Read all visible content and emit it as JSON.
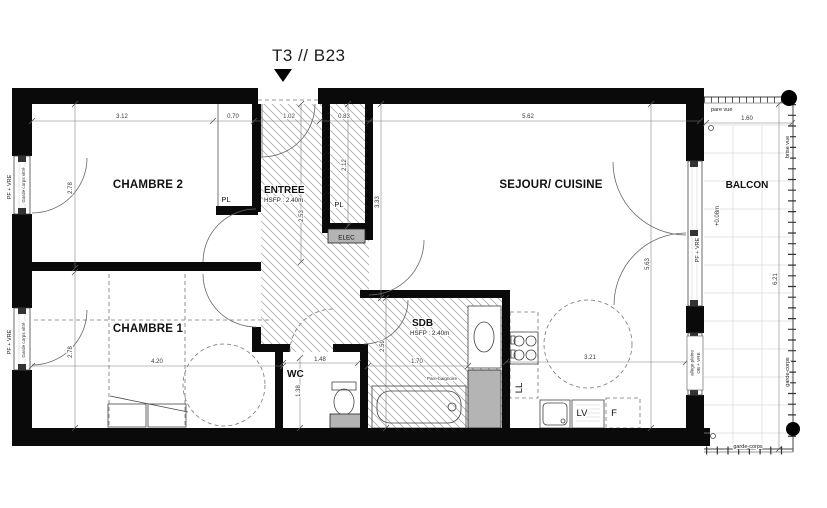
{
  "title": "T3 // B23",
  "rooms": {
    "chambre2": "CHAMBRE 2",
    "chambre1": "CHAMBRE 1",
    "entree": "ENTREE",
    "sejour": "SEJOUR/ CUISINE",
    "sdb": "SDB",
    "wc": "WC",
    "balcon": "BALCON"
  },
  "notes": {
    "entree_hsfp": "HSFP : 2.40m",
    "sdb_hsfp": "HSFP : 2.40m"
  },
  "fixtures": {
    "pl_chambre2": "PL",
    "pl_entree": "PL",
    "elec": "ELEC",
    "ll": "LL",
    "lv": "LV",
    "f": "F",
    "pare_baignoire": "Pare-baignoire"
  },
  "openings": {
    "pf_vre_chambre2": "PF + VRE",
    "pf_vre_chambre1": "PF + VRE",
    "pf_vre_sejour": "PF + VRE",
    "garde_corps_vitre_chambre2": "Garde corps vitré",
    "garde_corps_vitre_chambre1": "Garde corps vitré",
    "allege_line1": "allège pleine",
    "allege_line2": "OB + VRE"
  },
  "balcony": {
    "pare_vue": "pare vue",
    "brise_vue": "brise vue",
    "garde_corps_side": "garde-corps",
    "garde_corps_bottom": "garde-corps",
    "level": "+0.08m",
    "width": "1.60",
    "length": "6.21"
  },
  "dimensions": {
    "chambre2_width": "3.12",
    "chambre2_closet": "0.70",
    "entree_width": "1.02",
    "closet_width": "0.83",
    "sejour_width": "5.62",
    "chambre2_depth": "2.78",
    "chambre1_depth": "2.78",
    "chambre1_width": "4.20",
    "entree_depth": "2.53",
    "closet_depth": "2.12",
    "sejour_left": "3.33",
    "sejour_right": "5.63",
    "sdb_depth": "2.59",
    "sdb_width": "1.70",
    "wc_width": "1.48",
    "wc_depth": "1.38",
    "cuisine_width": "3.21"
  }
}
